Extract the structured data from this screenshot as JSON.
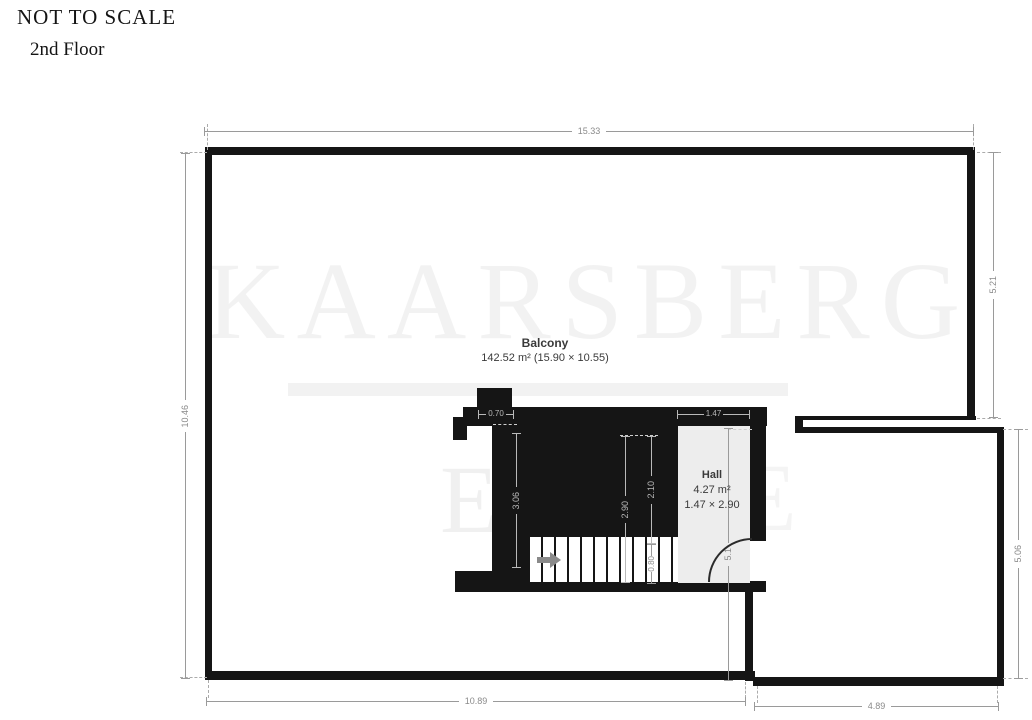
{
  "header": {
    "not_to_scale": "NOT TO SCALE",
    "floor_label": "2nd Floor"
  },
  "watermark": {
    "main": "KAARSBERG",
    "fragment_left": "E",
    "fragment_right": "E"
  },
  "rooms": {
    "balcony": {
      "name": "Balcony",
      "area_line": "142.52 m² (15.90 × 10.55)"
    },
    "hall": {
      "name": "Hall",
      "area": "4.27 m²",
      "dims": "1.47 × 2.90"
    }
  },
  "dimensions": {
    "top": "15.33",
    "left": "10.46",
    "right_upper": "5.21",
    "right_lower": "5.06",
    "bottom_left": "10.89",
    "bottom_right": "4.89",
    "hall_vertical": "5.1",
    "stair_depth": "3.06",
    "stair_total": "2.90",
    "stair_upper": "2.10",
    "stair_lower": "0.80",
    "landing": "0.70",
    "hall_width": "1.47"
  },
  "colors": {
    "wall": "#151515",
    "dimension": "#8a8a8a",
    "hall_floor": "#ededed",
    "label_text": "#3a3a3a"
  }
}
